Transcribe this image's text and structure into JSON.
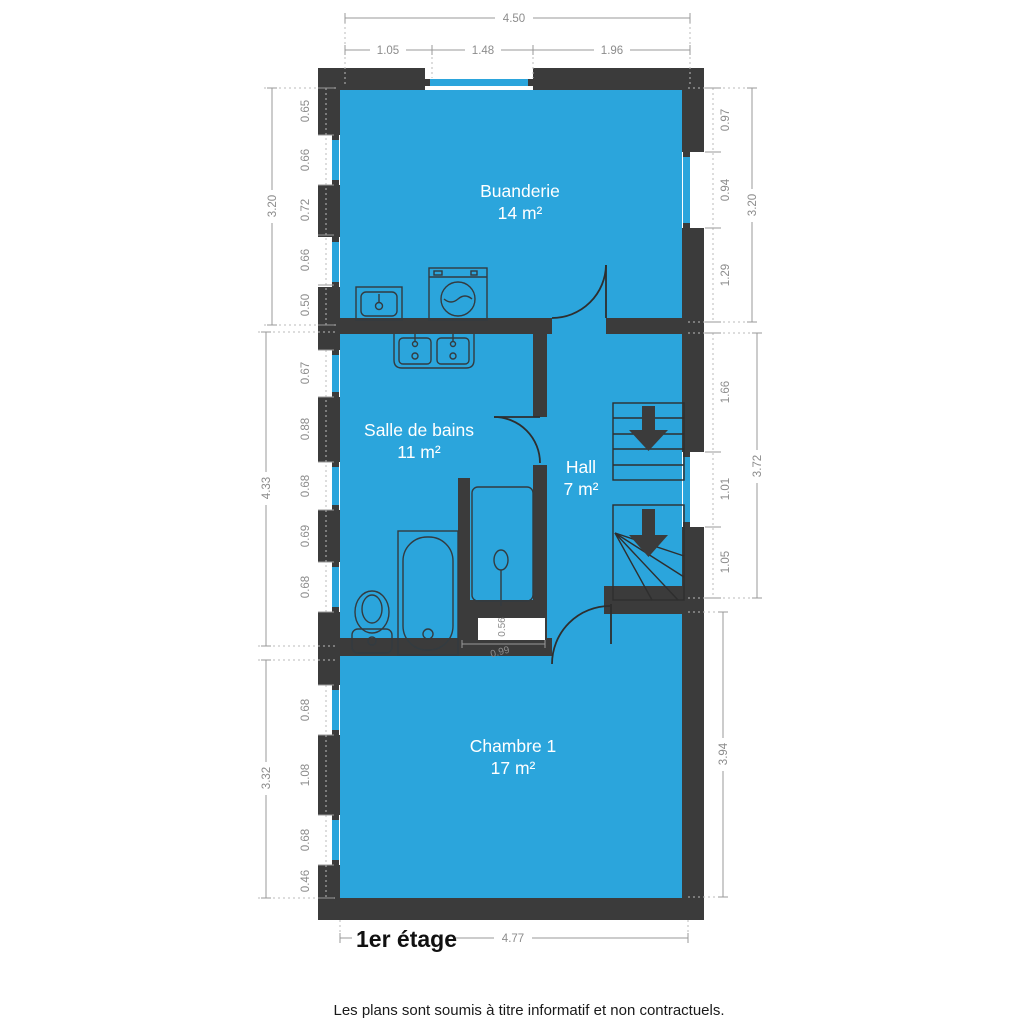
{
  "floor_title": "1er étage",
  "disclaimer": "Les plans sont soumis à titre informatif et non contractuels.",
  "rooms": {
    "buanderie": {
      "name": "Buanderie",
      "area": "14 m²"
    },
    "salle_de_bains": {
      "name": "Salle de bains",
      "area": "11 m²"
    },
    "hall": {
      "name": "Hall",
      "area": "7 m²"
    },
    "chambre1": {
      "name": "Chambre 1",
      "area": "17 m²"
    }
  },
  "dimensions": {
    "top": {
      "total": "4.50",
      "segments": [
        "1.05",
        "1.48",
        "1.96"
      ]
    },
    "left_upper": {
      "total": "3.20",
      "segments": [
        "0.65",
        "0.66",
        "0.72",
        "0.66",
        "0.50"
      ]
    },
    "right_upper": {
      "total": "3.20",
      "segments": [
        "0.97",
        "0.94",
        "1.29"
      ]
    },
    "left_middle": {
      "total": "4.33",
      "segments": [
        "0.67",
        "0.88",
        "0.68",
        "0.69",
        "0.68"
      ]
    },
    "right_middle": {
      "total": "3.72",
      "segments": [
        "1.66",
        "1.01",
        "1.05"
      ]
    },
    "left_lower": {
      "total": "3.32",
      "segments": [
        "0.68",
        "1.08",
        "0.68",
        "0.46"
      ]
    },
    "right_lower": {
      "total": "3.94"
    },
    "bottom": {
      "total": "4.77"
    },
    "shower": {
      "width": "0.56",
      "depth": "0.99"
    }
  },
  "fixtures": [
    "washing-machine",
    "laundry-sink",
    "double-sink-vanity",
    "bathtub",
    "toilet",
    "shower",
    "staircase-down",
    "door-swing"
  ],
  "colors": {
    "room_fill": "#2BA5DC",
    "wall": "#3B3B3B",
    "dimension_text": "#8C8C8C",
    "room_label": "#FFFFFF",
    "title_text": "#111111",
    "background": "#FFFFFF"
  }
}
